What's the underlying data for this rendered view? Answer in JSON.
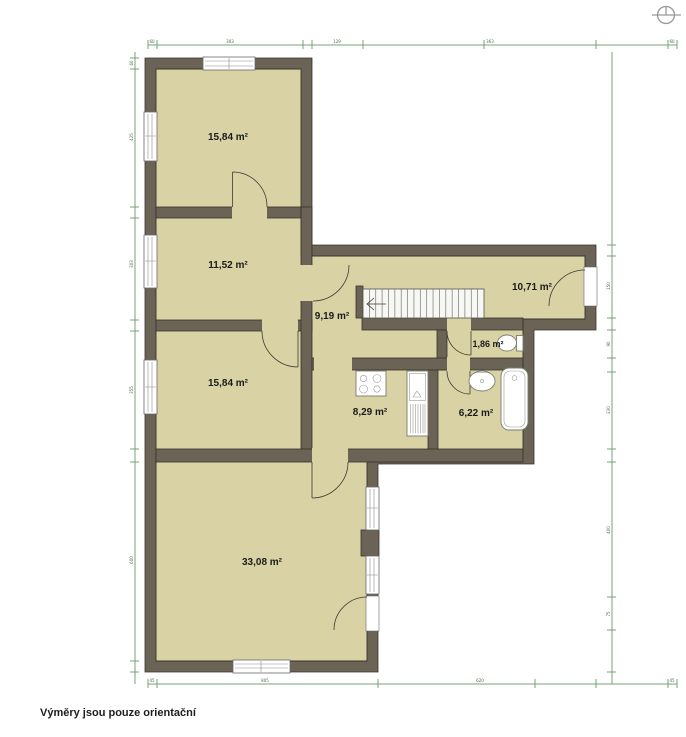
{
  "page": {
    "caption": "Výměry jsou pouze orientační"
  },
  "colors": {
    "wall": "#6b6355",
    "room_fill": "#d8d2a5",
    "dimension_line": "#74a476",
    "background": "#ffffff",
    "label_text": "#1b1b1b"
  },
  "rooms": [
    {
      "id": "room-top-left",
      "area": "15,84 m²"
    },
    {
      "id": "room-second",
      "area": "11,52 m²"
    },
    {
      "id": "hallway",
      "area": "9,19 m²"
    },
    {
      "id": "room-right",
      "area": "10,71 m²"
    },
    {
      "id": "wc",
      "area": "1,86 m²"
    },
    {
      "id": "room-middle",
      "area": "15,84 m²"
    },
    {
      "id": "kitchen",
      "area": "8,29 m²"
    },
    {
      "id": "bathroom",
      "area": "6,22 m²"
    },
    {
      "id": "living-room",
      "area": "33,08 m²"
    }
  ],
  "fixtures": [
    "staircase",
    "stove",
    "kitchen-unit",
    "washbasin",
    "bathtub",
    "toilet"
  ],
  "stairs": {
    "x": 363,
    "y": 289,
    "w": 121,
    "h": 29,
    "treads": 19
  },
  "dimensions": {
    "top": {
      "y": 45,
      "x1": 148,
      "x2": 677,
      "ticks": [
        148,
        157,
        303,
        312,
        363,
        484,
        596,
        668,
        677
      ],
      "labels": [
        {
          "x": 152,
          "t": "60"
        },
        {
          "x": 230,
          "t": "303"
        },
        {
          "x": 337,
          "t": "129"
        },
        {
          "x": 490,
          "t": "363"
        },
        {
          "x": 672,
          "t": "60"
        }
      ]
    },
    "bottom": {
      "y": 684,
      "x1": 148,
      "x2": 677,
      "ticks": [
        148,
        157,
        378,
        535,
        596,
        668,
        677
      ],
      "labels": [
        {
          "x": 152,
          "t": "45"
        },
        {
          "x": 265,
          "t": "805"
        },
        {
          "x": 480,
          "t": "620"
        },
        {
          "x": 672,
          "t": "45"
        }
      ]
    },
    "left": {
      "x": 135,
      "y1": 52,
      "y2": 684,
      "ticks": [
        58,
        69,
        207,
        218,
        320,
        331,
        449,
        462,
        661,
        672
      ],
      "labels": [
        {
          "y": 63,
          "t": "60"
        },
        {
          "y": 137,
          "t": "425"
        },
        {
          "y": 264,
          "t": "303"
        },
        {
          "y": 390,
          "t": "355"
        },
        {
          "y": 560,
          "t": "600"
        }
      ]
    },
    "right": {
      "x": 612,
      "y1": 52,
      "y2": 684,
      "ticks": [
        245,
        256,
        318,
        330,
        358,
        372,
        449,
        462,
        597,
        630,
        672
      ],
      "labels": [
        {
          "y": 286,
          "t": "150"
        },
        {
          "y": 344,
          "t": "90"
        },
        {
          "y": 410,
          "t": "230"
        },
        {
          "y": 530,
          "t": "400"
        },
        {
          "y": 614,
          "t": "75"
        }
      ]
    }
  }
}
